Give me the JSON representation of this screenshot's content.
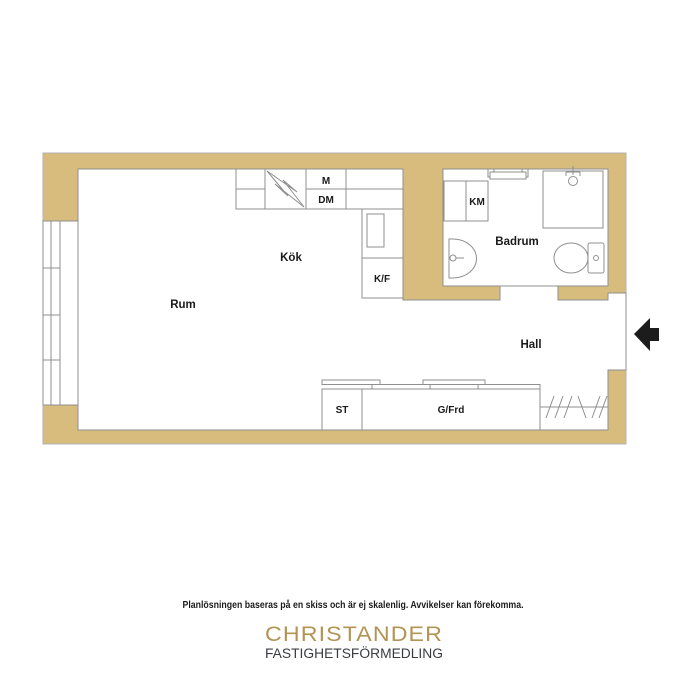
{
  "colors": {
    "wall": "#d7bc7e",
    "line": "#8f8f8f",
    "label": "#1a1a1a",
    "arrow": "#1c1c1c",
    "brand_gold": "#b29455",
    "brand_dark": "#3a3c40"
  },
  "plan": {
    "labels": {
      "rum": "Rum",
      "kok": "Kök",
      "badrum": "Badrum",
      "hall": "Hall",
      "m": "M",
      "dm": "DM",
      "kf": "K/F",
      "km": "KM",
      "st": "ST",
      "gfrd": "G/Frd"
    }
  },
  "footer": {
    "disclaimer": "Planlösningen baseras på en skiss och är ej skalenlig. Avvikelser kan förekomma.",
    "brand": "CHRISTANDER",
    "brand_sub": "FASTIGHETSFÖRMEDLING"
  }
}
